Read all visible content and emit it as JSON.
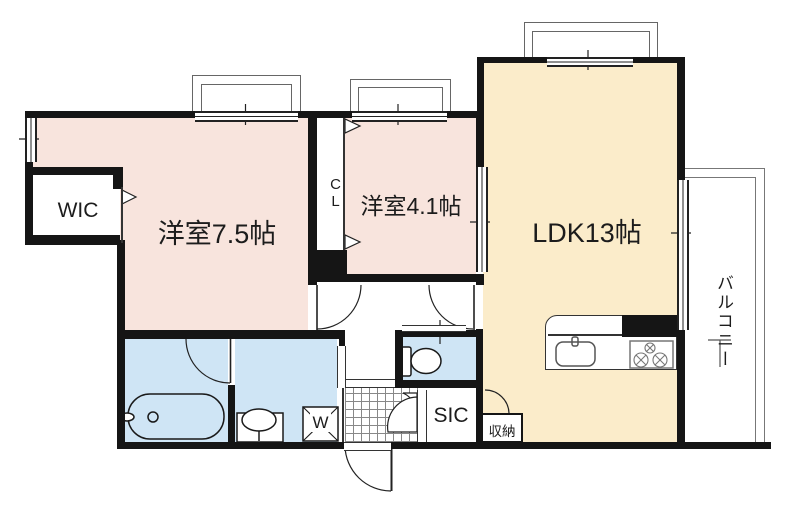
{
  "floorplan": {
    "type": "apartment-floor-plan",
    "rooms": {
      "bedroom1": {
        "label": "洋室7.5帖"
      },
      "bedroom2": {
        "label": "洋室4.1帖"
      },
      "ldk": {
        "label": "LDK13帖"
      },
      "wic": {
        "label": "WIC"
      },
      "closet": {
        "label": "CL"
      },
      "balcony": {
        "label": "バルコニー"
      },
      "sic": {
        "label": "SIC"
      },
      "storage": {
        "label": "収納"
      },
      "laundry": {
        "label": "W"
      }
    },
    "colors": {
      "bedroom_pink": "#f8e4dd",
      "ldk_cream": "#fbecca",
      "wet_area_blue": "#cfe5f5",
      "wall_black": "#151515",
      "frame_gray": "#666666",
      "balcony_gray": "#777777"
    },
    "fixtures": [
      "bathtub",
      "toilet",
      "vanity-sink",
      "washing-machine",
      "kitchen-sink",
      "gas-stove",
      "entrance-door",
      "window",
      "sliding-door",
      "folding-door",
      "balcony-partition"
    ]
  }
}
